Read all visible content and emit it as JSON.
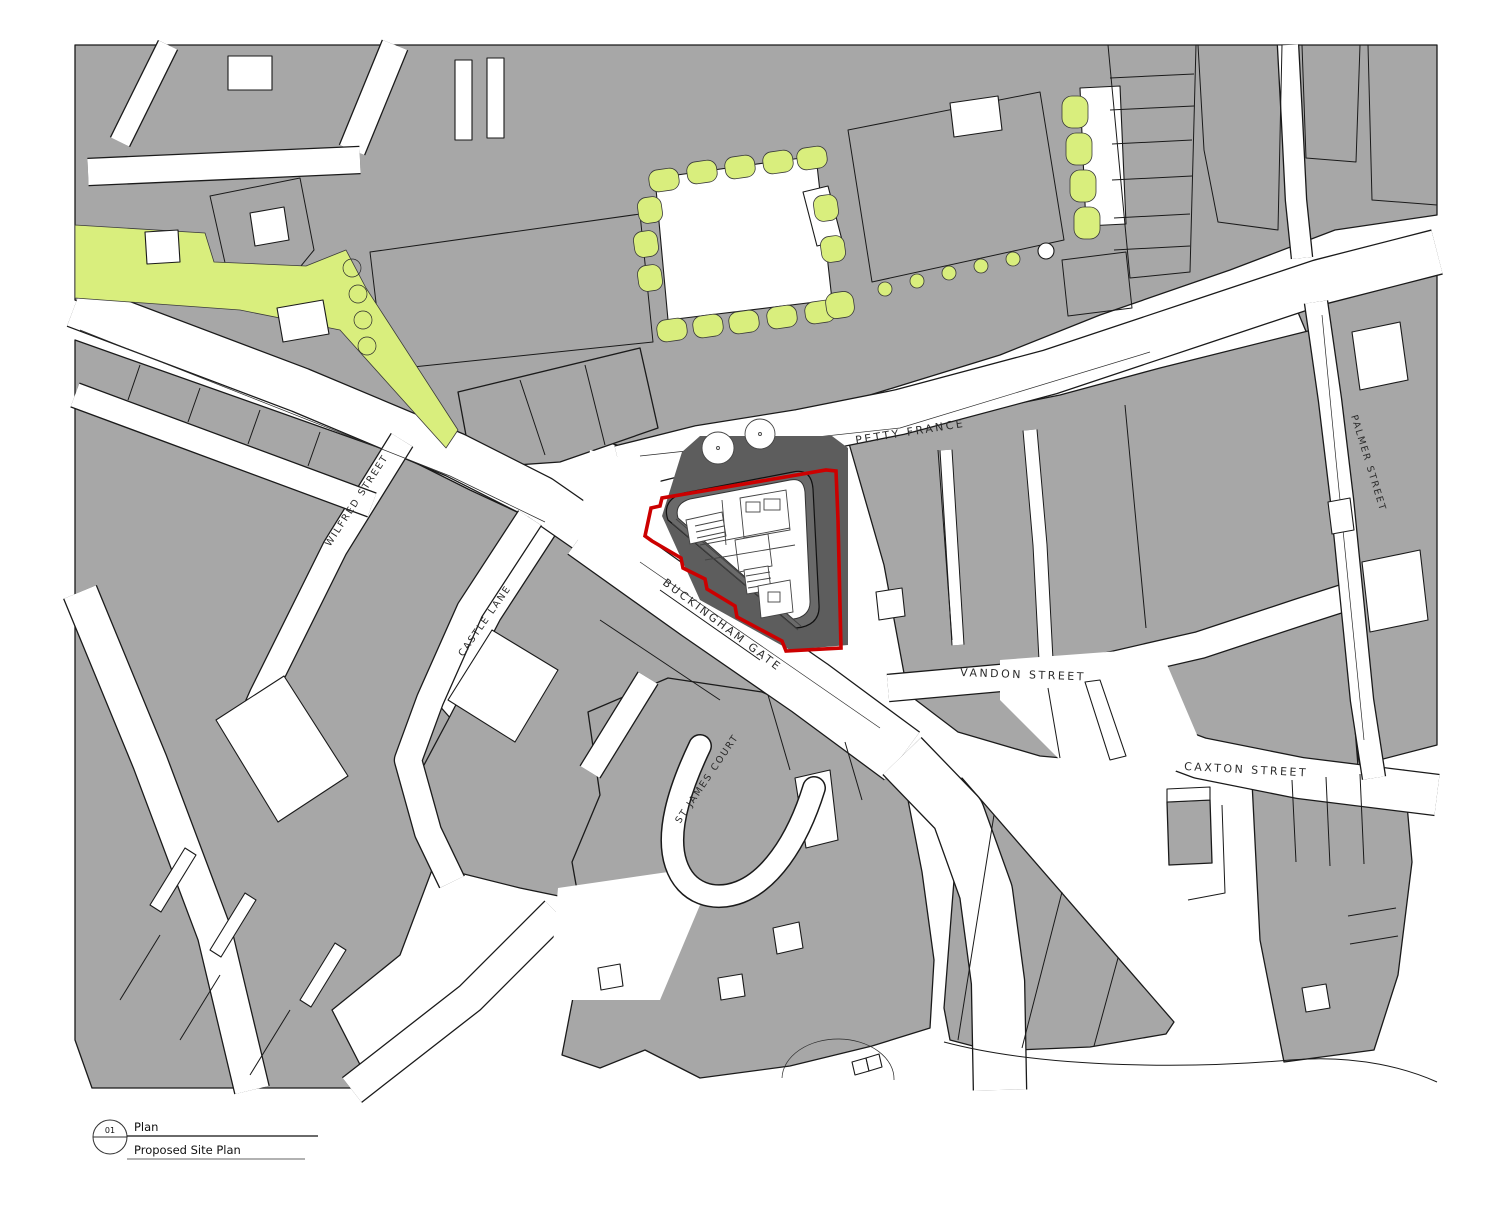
{
  "drawing": {
    "streets": {
      "petty_france": "PETTY FRANCE",
      "buckingham_gate": "BUCKINGHAM GATE",
      "vandon_street": "VANDON STREET",
      "caxton_street": "CAXTON STREET",
      "palmer_street": "PALMER STREET",
      "wilfred_street": "WILFRED STREET",
      "castle_lane": "CASTLE LANE",
      "st_james_court": "ST JAMES COURT"
    },
    "colors": {
      "building_fill": "#a7a7a7",
      "outline": "#1a1a1a",
      "landscape_green": "#d9ee7d",
      "site_shadow": "#5d5d5d",
      "site_boundary_red": "#cc0000",
      "paper": "#ffffff"
    },
    "title_block": {
      "ref_number": "01",
      "view_type": "Plan",
      "view_title": "Proposed Site Plan"
    }
  }
}
